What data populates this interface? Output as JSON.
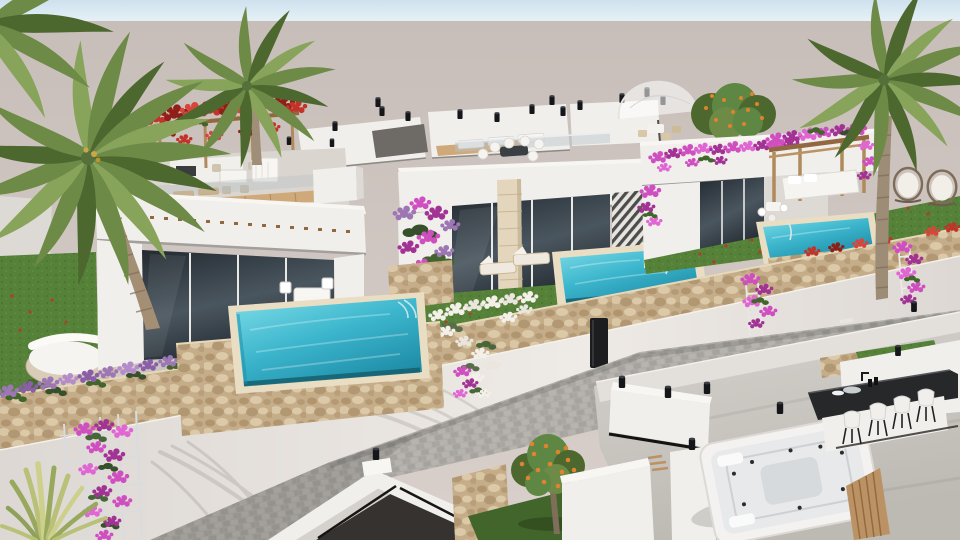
{
  "scene": {
    "type": "3d-architectural-exterior-render",
    "description": "Aerial daytime rendering of a resort development: a row of modern flat-roof white villas with private turquoise pools, rooftop terraces, bougainvillea, palm trees, a cobblestone street and a foreground roof terrace with jacuzzi and bar",
    "time_of_day": "day",
    "objects": [
      "sky",
      "haze-backdrop",
      "far-rooftops",
      "left-villa",
      "center-villa",
      "right-villa",
      "left-pool",
      "center-pool",
      "right-pool",
      "rooftop-red-pergola",
      "dome-umbrella",
      "garden-pergola-daybed",
      "egg-chairs",
      "stone-garden-wall",
      "street-wall",
      "street-gate",
      "cobblestone-road",
      "road-marking",
      "bougainvillea-trellis",
      "agave-plant",
      "round-daybed",
      "orange-trees",
      "front-roof-terrace",
      "jacuzzi",
      "bar-counter",
      "bar-stools",
      "roof-lamps",
      "palm-tree-left",
      "palm-tree-middle",
      "palm-tree-right",
      "lawns",
      "banana-plants"
    ],
    "palette": {
      "sky_top": "#cfe1ee",
      "sky_bottom": "#e6f1f6",
      "haze_top": "#c8beb9",
      "haze_bottom": "#d9d0cb",
      "wall_white": "#f1efec",
      "wall_bright": "#f8f6f3",
      "wall_shade": "#ddd9d5",
      "wall_deep": "#c8c4c0",
      "street_wall": "#ddd8d3",
      "street_wall_light": "#eeeae6",
      "glass_dark": "#232a31",
      "glass_light": "#4a565f",
      "pool_light": "#7fdde8",
      "pool_mid": "#3cb6cd",
      "pool_deep": "#1e8ca6",
      "pool_edge": "#156070",
      "stone_base": "#c6ad8a",
      "stone_dark": "#aa8f68",
      "stone_light": "#dcc9a8",
      "coping": "#e9ddc3",
      "road_base": "#afaca7",
      "road_dark": "#9f9c97",
      "road_light": "#bfbcb7",
      "grass": "#558138",
      "grass_dark": "#41652a",
      "grass_light": "#6b9a4a",
      "magenta": "#cf4fc0",
      "magenta_dark": "#a23395",
      "red_flower": "#c23329",
      "red_dark": "#8f1f17",
      "white_flower": "#f3efe9",
      "lavender": "#9c77b4",
      "palm_green": "#6d8a46",
      "palm_dark": "#4c682f",
      "palm_light": "#87a45a",
      "trunk": "#a08f78",
      "trunk_dark": "#7e6e5a",
      "wood": "#bb9263",
      "wood_dark": "#91683f",
      "orange_fruit": "#e0832e",
      "floor_light": "#d6d2cd",
      "floor_dark": "#bdb9b3",
      "black": "#16171a"
    }
  }
}
